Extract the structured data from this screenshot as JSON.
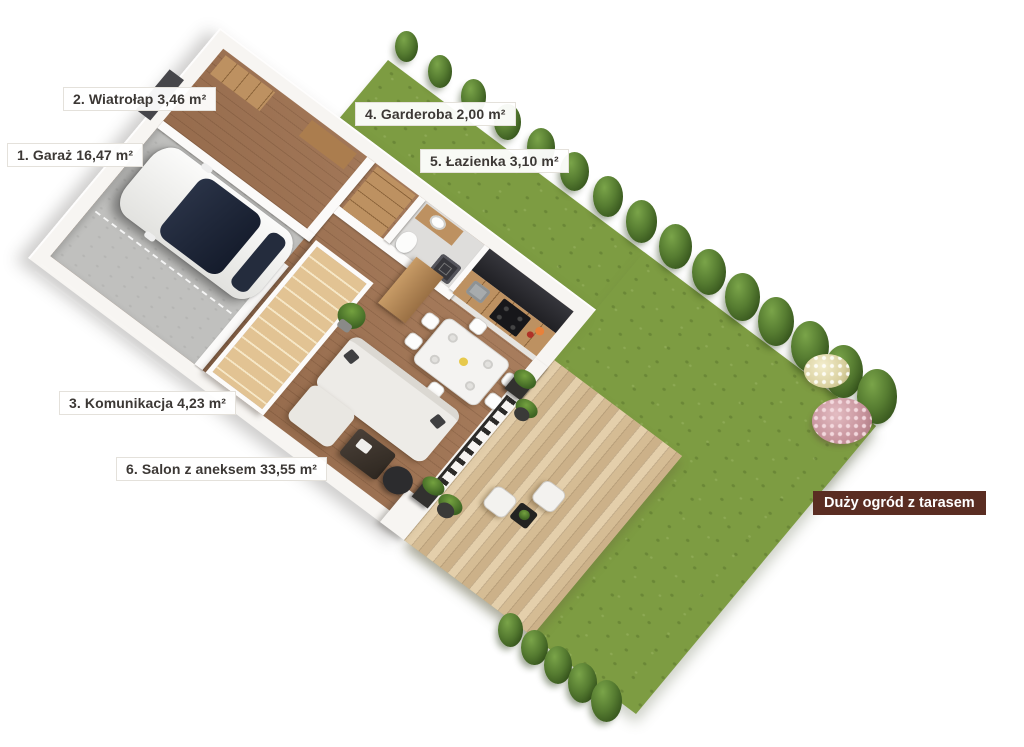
{
  "page": {
    "background": "#ffffff"
  },
  "plan_labels": [
    {
      "id": "garaz",
      "number": "1",
      "name": "Garaż",
      "area": "16,47 m²",
      "text": "1. Garaż 16,47 m²"
    },
    {
      "id": "wiatrolap",
      "number": "2",
      "name": "Wiatrołap",
      "area": "3,46 m²",
      "text": "2. Wiatrołap 3,46 m²"
    },
    {
      "id": "komunikacja",
      "number": "3",
      "name": "Komunikacja",
      "area": "4,23 m²",
      "text": "3. Komunikacja 4,23 m²"
    },
    {
      "id": "garderoba",
      "number": "4",
      "name": "Garderoba",
      "area": "2,00 m²",
      "text": "4. Garderoba 2,00 m²"
    },
    {
      "id": "lazienka",
      "number": "5",
      "name": "Łazienka",
      "area": "3,10 m²",
      "text": "5. Łazienka 3,10 m²"
    },
    {
      "id": "salon",
      "number": "6",
      "name": "Salon z aneksem",
      "area": "33,55 m²",
      "text": "6. Salon z aneksem 33,55 m²"
    }
  ],
  "garden_badge": {
    "text": "Duży ogród z tarasem",
    "bg": "#5a2d22",
    "fg": "#ffffff"
  },
  "flora": {
    "top_tree_count": 15,
    "bottom_tree_count": 5,
    "bushes": [
      {
        "type": "cream"
      },
      {
        "type": "pink"
      }
    ]
  },
  "colors": {
    "grass": "#7d9c42",
    "deck": "#dcc6a2",
    "wood_floor": "#a07251",
    "wall": "#f7f5f2",
    "counter": "#2d2d30",
    "cabinet_wood": "#bd9161",
    "garage_floor": "#c0c0be",
    "stair": "#e2c393",
    "door": "#46464a",
    "car_body": "#f4f4f2",
    "car_glass": "#1d2433",
    "railing": "#2b2a28",
    "badge_bg": "#5a2d22",
    "label_text": "#3c3835",
    "tree": "#4a6b2d"
  }
}
